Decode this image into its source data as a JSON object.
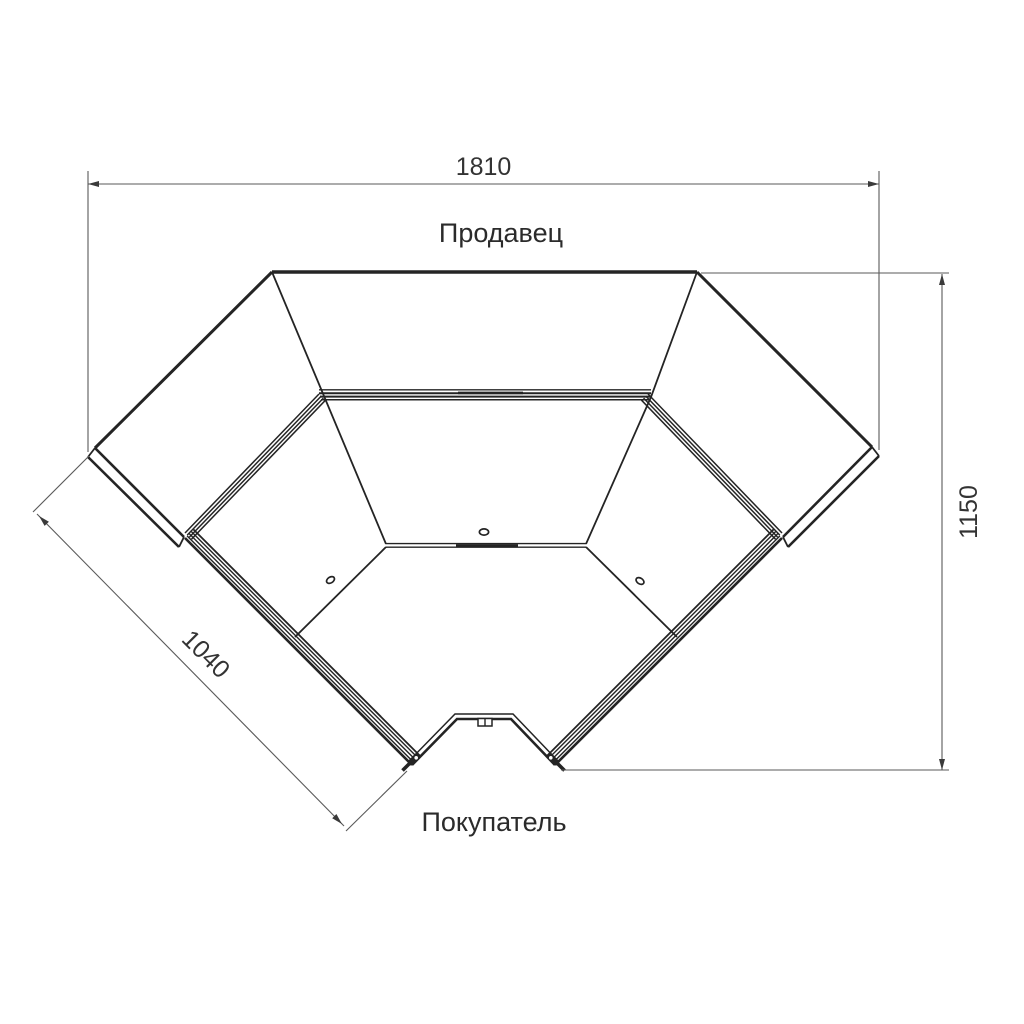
{
  "drawing": {
    "labels": {
      "seller": "Продавец",
      "buyer": "Покупатель"
    },
    "dimensions": {
      "overall_width": "1810",
      "overall_depth": "1150",
      "front_section": "1040"
    },
    "colors": {
      "line": "#242424",
      "dimension_line": "#5a5a5a",
      "label_text": "#2b2b2b",
      "dimension_text": "#333333",
      "background": "#ffffff"
    }
  }
}
